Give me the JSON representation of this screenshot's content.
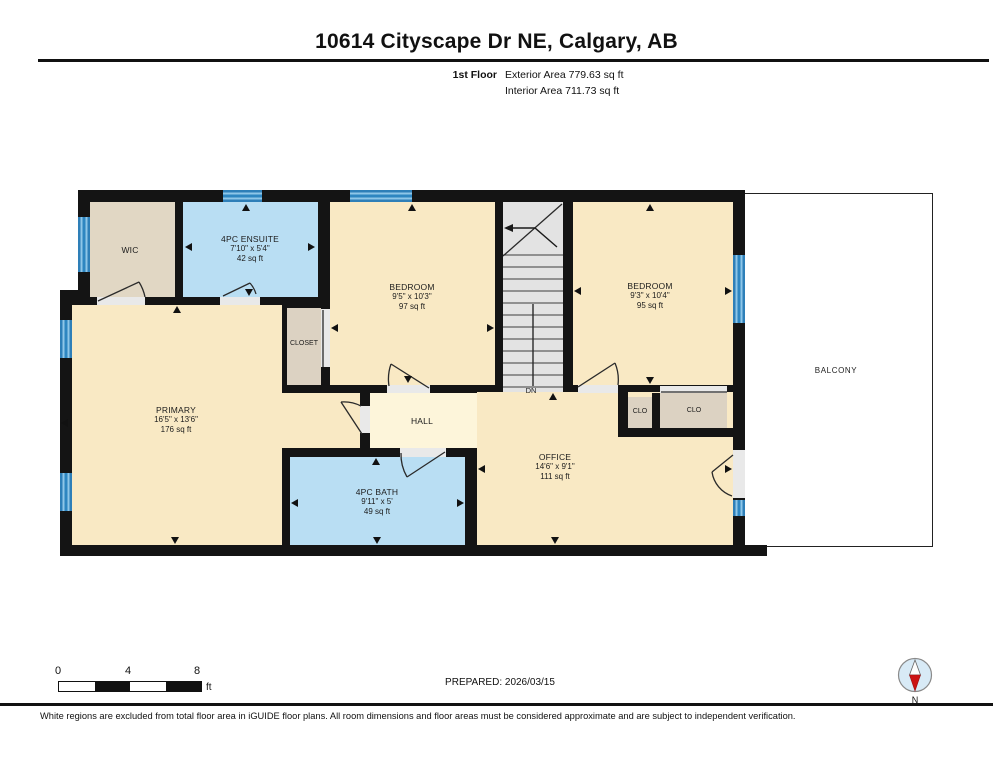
{
  "header": {
    "title": "10614 Cityscape Dr NE, Calgary, AB",
    "floor_label": "1st Floor",
    "exterior_area": "Exterior Area 779.63 sq ft",
    "interior_area": "Interior Area 711.73 sq ft"
  },
  "plan": {
    "rooms": {
      "wic": {
        "name": "WIC"
      },
      "ensuite": {
        "name": "4PC ENSUITE",
        "dims": "7'10\" x 5'4\"",
        "area": "42 sq ft"
      },
      "closet": {
        "name": "CLOSET"
      },
      "bedroom1": {
        "name": "BEDROOM",
        "dims": "9'5\" x 10'3\"",
        "area": "97 sq ft"
      },
      "bedroom2": {
        "name": "BEDROOM",
        "dims": "9'3\" x 10'4\"",
        "area": "95 sq ft"
      },
      "primary": {
        "name": "PRIMARY",
        "dims": "16'5\" x 13'6\"",
        "area": "176 sq ft"
      },
      "hall": {
        "name": "HALL"
      },
      "bath": {
        "name": "4PC BATH",
        "dims": "9'11\" x 5'",
        "area": "49 sq ft"
      },
      "office": {
        "name": "OFFICE",
        "dims": "14'6\" x 9'1\"",
        "area": "111 sq ft"
      },
      "clo_small": {
        "name": "CLO"
      },
      "clo_large": {
        "name": "CLO"
      },
      "balcony": {
        "name": "BALCONY"
      },
      "stairs_down_label": "DN"
    },
    "colors": {
      "wall_black": "#141414",
      "room_cream": "#f9e9c4",
      "hall_cream": "#fdf5da",
      "wet_room_blue": "#b9def3",
      "closet_tan": "#dcd2c2",
      "stairs_gray": "#e3e3e3",
      "window_blue": "#2e86c1"
    }
  },
  "footer": {
    "scale_ticks": [
      "0",
      "4",
      "8"
    ],
    "scale_unit": "ft",
    "prepared": "PREPARED: 2026/03/15",
    "compass_label": "N",
    "disclaimer": "White regions are excluded from total floor area in iGUIDE floor plans. All room dimensions and floor areas must be considered approximate and are subject to independent verification."
  }
}
